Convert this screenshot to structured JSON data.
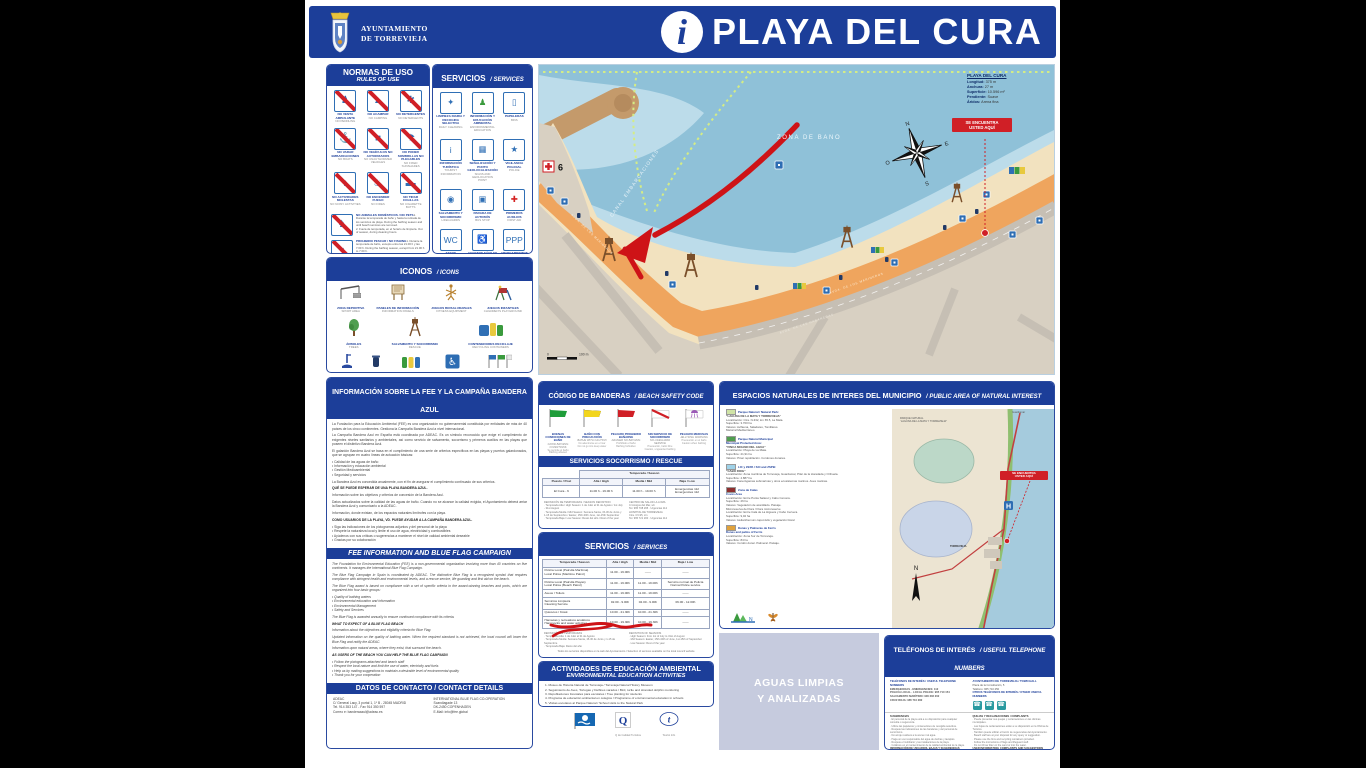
{
  "header": {
    "muni1": "AYUNTAMIENTO",
    "muni2": "DE TORREVIEJA",
    "info_glyph": "i",
    "title": "PLAYA DEL CURA"
  },
  "normas": {
    "title": "NORMAS DE USO",
    "subtitle": "RULES OF USE",
    "items": [
      {
        "glyph": "♟",
        "es": "NO VENTA AMBULANTE",
        "en": "NO PEDDLING"
      },
      {
        "glyph": "▲",
        "es": "NO ACAMPAR",
        "en": "NO CAMPING"
      },
      {
        "glyph": "✱",
        "es": "NO DETERGENTES",
        "en": "NO DETERGENTS"
      },
      {
        "glyph": "⚓",
        "es": "NO VARAR EMBARCACIONES",
        "en": "NO BOATS"
      },
      {
        "glyph": "■",
        "es": "NO VEHÍCULOS NO AUTORIZADOS",
        "en": "NO UNAUTHORIZED VEHICLES"
      },
      {
        "glyph": "☂",
        "es": "NO PONER SOMBRILLAS NO PLEGABLES",
        "en": "NO FIXED SUNSHADES"
      },
      {
        "glyph": "♪",
        "es": "NO ACTIVIDADES MOLESTAS",
        "en": "NO NOISY ACTIVITIES"
      },
      {
        "glyph": "♨",
        "es": "NO ENCENDER FUEGO",
        "en": "NO FIRES"
      },
      {
        "glyph": "▬",
        "es": "NO TIRAR COLILLAS",
        "en": "NO CIGARETTE BUTTS"
      }
    ],
    "extras": [
      {
        "glyph": "♞",
        "title": "NO ANIMALES DOMÉSTICOS / NO PETS",
        "text": "1. Durante la temporada de baño y hasta la retirada de los servicios de playa. During the bathing season and until beach services are removed.\n2. Fuera de temporada, en el horario de limpieza. Out of season, during cleaning hours."
      },
      {
        "glyph": "♆",
        "title": "PROHIBIDO PESCAR / NO FISHING",
        "text": "1. Durante la temporada de baño, excepto entre las 21.00 h y las 7.00 h. During the bathing season, except from 21.00 h to 7.00 h.\n2. Prohibida la pesca submarina en las zonas de baño. Spearfishing is forbidden in bathing areas."
      }
    ]
  },
  "servicios_panel": {
    "title": "SERVICIOS",
    "subtitle": "SERVICES",
    "items": [
      {
        "glyph": "✦",
        "color": "#2f6fb5",
        "es": "LIMPIEZA DIARIA Y RECOGIDA SELECTIVA",
        "en": "DAILY CLEANING"
      },
      {
        "glyph": "♟",
        "color": "#3a9a3d",
        "es": "INFORMACIÓN Y EDUCACIÓN AMBIENTAL",
        "en": "ENVIRONMENTAL EDUCATION"
      },
      {
        "glyph": "▯",
        "color": "#2f6fb5",
        "es": "PAPELERAS",
        "en": "BINS"
      },
      {
        "glyph": "i",
        "color": "#2f6fb5",
        "es": "INFORMACIÓN TURÍSTICA",
        "en": "TOURIST INFORMATION"
      },
      {
        "glyph": "▦",
        "color": "#2f6fb5",
        "es": "SEÑALIZACIÓN Y PUNTO GEOLOCALIZACIÓN",
        "en": "SIGNS AND GEOLOCATION POINT"
      },
      {
        "glyph": "★",
        "color": "#2f6fb5",
        "es": "VIGILANCIA POLICIAL",
        "en": "POLICE"
      },
      {
        "glyph": "◉",
        "color": "#2f6fb5",
        "es": "SALVAMENTO Y SOCORRISMO",
        "en": "LIFEGUARDS"
      },
      {
        "glyph": "▣",
        "color": "#2f6fb5",
        "es": "PARADA DE AUTOBÚS",
        "en": "BUS STOP"
      },
      {
        "glyph": "✚",
        "color": "#d42222",
        "es": "PRIMEROS AUXILIOS",
        "en": "FIRST AID"
      },
      {
        "glyph": "WC",
        "color": "#2f6fb5",
        "es": "ASEOS ADAPTADOS",
        "en": "ADAPTED TOILETS"
      },
      {
        "glyph": "♿",
        "color": "#2f6fb5",
        "es": "ACCESOS FÁCILES Y SEGUROS",
        "en": "EASY AND SAFE ACCESS"
      },
      {
        "glyph": "PPP",
        "color": "#2f6fb5",
        "es": "APARCAMIENTOS RESERVADOS",
        "en": "RESERVED PARKING"
      }
    ]
  },
  "iconos": {
    "title": "ICONOS",
    "subtitle": "ICONS",
    "items": [
      {
        "es": "ZONA DEPORTIVA",
        "en": "SPORT AREA"
      },
      {
        "es": "PANELES DE INFORMACIÓN",
        "en": "INFORMATION PANELS"
      },
      {
        "es": "JUEGOS BIOSALUDABLES",
        "en": "FITNESS EQUIPMENT"
      },
      {
        "es": "JUEGOS INFANTILES",
        "en": "CHILDREN'S PLAYGROUND"
      },
      {
        "es": "ÁRBOLES",
        "en": "TREES"
      },
      {
        "es": "SALVAMENTO Y SOCORRISMO",
        "en": "RESCUE"
      },
      {
        "es": "CONTENEDORES RECICLAJE",
        "en": "RECYCLING CONTAINERS"
      },
      {
        "es": "LAVAPIÉS",
        "en": "FOOT SHOWERS"
      },
      {
        "es": "PAPELERA",
        "en": "BIN"
      },
      {
        "es": "PAPELERAS RECICLAJE",
        "en": "RECYCLING BINS"
      },
      {
        "es": "ASEO ADAPTADO",
        "en": "ADAPTED TOILET"
      },
      {
        "es": "BANDERAS Y CERTIFICACIONES",
        "en": "FLAGS AND CERTIFICATIONS"
      }
    ]
  },
  "fee": {
    "title": "INFORMACIÓN SOBRE LA FEE Y LA CAMPAÑA BANDERA AZUL",
    "es_blocks": [
      {
        "cls": "p",
        "text": "La Fundación para la Educación Ambiental (FEE) es una organización no gubernamental constituida por entidades de más de 40 países de los cinco continentes. Gestiona la Campaña Bandera Azul a nivel internacional."
      },
      {
        "cls": "p",
        "text": "La Campaña Bandera Azul en España está coordinada por ADEAC. Es un símbolo reconocido que exige el cumplimiento de exigentes niveles sanitarios y ambientales, así como servicio de salvamento, socorrismo y primeros auxilios en las playas que poseen el distintivo Bandera Azul."
      },
      {
        "cls": "p",
        "text": "El galardón Bandera Azul se basa en el cumplimiento de una serie de criterios específicos en las playas y puertos galardonados, que se agrupan en cuatro líneas de actuación básicas:"
      },
      {
        "cls": "p",
        "text": "• Calidad de las aguas de baño\n• Información y educación ambiental\n• Gestión Medioambiental\n• Seguridad y servicios"
      },
      {
        "cls": "p",
        "text": "La Bandera Azul es concedida anualmente, con el fin de asegurar el cumplimiento continuado de sus criterios."
      },
      {
        "cls": "h",
        "text": "QUÉ SE PUEDE ESPERAR DE UNA PLAYA BANDERA AZUL."
      },
      {
        "cls": "p",
        "text": "Información sobre los objetivos y criterios de concesión de la Bandera Azul."
      },
      {
        "cls": "p",
        "text": "Datos actualizados sobre la calidad de las aguas de baño. Cuando no se alcance la calidad exigida, el Ayuntamiento deberá arriar la Bandera Azul y comunicarlo a la ADEAC."
      },
      {
        "cls": "p",
        "text": "Información, donde existan, de los espacios naturales limítrofes con la playa."
      },
      {
        "cls": "h",
        "text": "COMO USUARIOS DE LA PLAYA, VD. PUEDE AYUDAR A LA CAMPAÑA BANDERA AZUL."
      },
      {
        "cls": "p",
        "text": "• Siga las indicaciones de los pictogramas adjuntos y del personal de la playa\n• Respete la naturaleza local y limite el uso de agua, electricidad y combustibles\n• Ayúdenos con sus críticas o sugerencias a mantener el nivel de calidad ambiental deseable\n• Gracias por su colaboración"
      }
    ],
    "mid": "FEE INFORMATION AND BLUE FLAG CAMPAIGN",
    "en_blocks": [
      {
        "cls": "p",
        "text": "The Foundation for Environmental Education (FEE) is a non-governmental organization involving more than 40 countries on five continents. It manages the International Blue Flag Campaign."
      },
      {
        "cls": "p",
        "text": "The Blue Flag Campaign in Spain is coordinated by ADEAC. The distinctive Blue Flag is a recognized symbol that requires compliance with stringent health and environmental levels, and a rescue service, life guarding and first aid on the beach."
      },
      {
        "cls": "p",
        "text": "The Blue Flag award is based on compliance with a set of specific criteria in the award-winning beaches and ports, which are organized into four basic groups:"
      },
      {
        "cls": "p",
        "text": "• Quality of bathing waters\n• Environmental education and information\n• Environmental Management\n• Safety and Services"
      },
      {
        "cls": "p",
        "text": "The Blue Flag is awarded annually to ensure continued compliance with its criteria."
      },
      {
        "cls": "h",
        "text": "WHAT TO EXPECT OF A BLUE FLAG BEACH"
      },
      {
        "cls": "p",
        "text": "Information about the objectives and eligibility criteria for Blue Flag."
      },
      {
        "cls": "p",
        "text": "Updated information on the quality of bathing water. When the required standard is not achieved, the local council will lower the Blue Flag and notify the ADEAC."
      },
      {
        "cls": "p",
        "text": "Information upon natural areas, where they exist, that surround the beach."
      },
      {
        "cls": "h",
        "text": "AS USERS OF THE BEACH YOU CAN HELP THE BLUE FLAG CAMPAIGN"
      },
      {
        "cls": "p",
        "text": "• Follow the pictograms attached and beach staff\n• Respect the local nature and limit the use of water, electricity and fuels\n• Help us by making suggestions to maintain a desirable level of environmental quality\n• Thank you for your cooperation"
      }
    ],
    "contact_title": "DATOS DE CONTACTO / CONTACT DETAILS",
    "contact_left": "ADEAC\nC/ General Lacy, 3 portal 1, 1º B - 28045 MADRID\nTel. 914 353 147 - Fax 914 350 597\nCorreo e: banderaazul@adeac.es",
    "contact_right": "INTERNATIONAL BLUE FLAG CO-OPERATION\nScandiagade 13\nDK-2450 COPENHAGEN\nE-Mail: info@fee.global"
  },
  "map": {
    "stats_title": "PLAYA DEL CURA",
    "stats": [
      {
        "k": "Longitud:",
        "v": "375 m"
      },
      {
        "k": "Anchura:",
        "v": "27 m"
      },
      {
        "k": "Superficie:",
        "v": "10.596 m²"
      },
      {
        "k": "Pendiente:",
        "v": "Suave"
      },
      {
        "k": "Áridos:",
        "v": "Arena fina"
      }
    ],
    "zona": "ZONA DE BAÑO",
    "canal": "CANAL EMBARCACIONES",
    "here": "SE ENCUENTRA\nUSTED AQUÍ",
    "street_prom": "AVDA. DE LOS MARINEROS",
    "street_back": "AVDA. DE LAS HABANERAS",
    "first_aid_num": "6",
    "compass": {
      "n": "N",
      "s": "S",
      "e": "E",
      "o": "O"
    },
    "scale_left": "0",
    "scale_right": "100 m"
  },
  "banderas": {
    "title": "CÓDIGO DE BANDERAS",
    "subtitle": "BEACH SAFETY CODE",
    "flags": [
      {
        "es": "BUENAS CONDICIONES DE BAÑO",
        "en": "GOOD BATHING CONDITIONS",
        "note": "Se permite el baño\nBathing allowed"
      },
      {
        "es": "BAÑO CON PRECAUCIÓN",
        "en": "BATHE WITH CAUTION",
        "note": "No adentrarse en el mar\nDo not go into deep water"
      },
      {
        "es": "PELIGRO PROHIBIDO BAÑARSE",
        "en": "DANGER NO BATHING",
        "note": "Prohibido el baño\nBathing forbidden"
      },
      {
        "es": "SIN SERVICIO DE SOCORRISMO",
        "en": "NO LIFEGUARD SERVICE",
        "note": "Precaución, baño libre\nCaution, unguarded bathing"
      },
      {
        "es": "PELIGRO MEDUSAS",
        "en": "JELLYFISH WARNING",
        "note": "Precaución en el baño\nCaution when bathing"
      }
    ]
  },
  "socorrismo": {
    "title": "SERVICIOS SOCORRISMO / RESCUE",
    "season_header": "Temporada / Season",
    "col_post": "Puesto / Post",
    "col_alta": "Alta / High",
    "col_media": "Media / Mid",
    "col_baja": "Baja / Low",
    "row": {
      "post": "El Cura - 6",
      "alta": "11.00 h - 19.00 h",
      "media": "11.00 h - 19.00 h",
      "baja": "Emergencias 112\nEmergencies 112"
    },
    "notes_left": "DEFINICIÓN DE TEMPORADAS / SEASON DEFINITION\n· Temporada Alta / High Season: 1 de Julio al 31 de Agosto / 1st July - 31st August\n· Temporada Media / Mid Season: Semana Santa, 15-30 de Junio y 1-15 de Septiembre / Easter, 15th-30th June, 1st-15th September\n· Temporada Baja / Low Season: Resto del año / Rest of the year",
    "notes_right": "CENTRO DE SALUD LA LOMA\nC/ Amigos del Mar, s/n\nTel. 965 708 295 · Urgencias 112\nHOSPITAL DE TORREVIEJA\nCtra. CV-95, s/n\nTel. 965 721 200 · Urgencias 112"
  },
  "servicios_tabla": {
    "title": "SERVICIOS",
    "subtitle": "SERVICES",
    "cols": [
      "Temporada / Season",
      "Alta / High",
      "Media / Mid",
      "Baja / Low"
    ],
    "rows": [
      {
        "label": "Policía Local (Patrulla Marítima)\nLocal Police (Maritime Patrol)",
        "alta": "11.00 - 19.00h",
        "media": "——",
        "baja": "——"
      },
      {
        "label": "Policía Local (Patrulla Playas)\nLocal Police (Beach Patrol)",
        "alta": "11.00 - 19.00h",
        "media": "11.00 - 19.00h",
        "baja": "Servicio normal de Policía\nNormal Police service"
      },
      {
        "label": "Aseos / Toilets",
        "alta": "11.00 - 19.00h",
        "media": "11.00 - 19.00h",
        "baja": "——"
      },
      {
        "label": "Servicios Limpieza\nCleaning Service",
        "alta": "02.00 - 9.00h",
        "media": "02.00 - 9.00h",
        "baja": "06.00 - 12.00h"
      },
      {
        "label": "Quioscos / Kiosk",
        "alta": "10.00 - 21.30h",
        "media": "10.00 - 21.30h",
        "baja": "——"
      },
      {
        "label": "Hamacas y recreativos acuáticos\nHammocks and water activities",
        "alta": "10.00 - 19.30h",
        "media": "10.00 - 19.30h",
        "baja": "——"
      }
    ],
    "notes_left": "DEFINICIÓN DE TEMPORADAS\n· Temporada Alta: 1 de Julio al 31 de Agosto\n· Temporada Media: Semana Santa, 15-30 de Junio y 1-15 de Septiembre\n· Temporada Baja: Resto del año",
    "notes_right": "DEFINITION OF SEASONS\n· High Season: from 1st of July to 31st of August\n· Mid Season: Easter, 15th-30th of June, 1st-15th of September\n· Low Season: Rest of the year",
    "footnote": "Todos los servicios disponibles en la web del Ayuntamiento / Selection of services available on the local council website"
  },
  "actividades": {
    "title": "ACTIVIDADES DE EDUCACIÓN AMBIENTAL",
    "subtitle": "ENVIRONMENTAL EDUCATION ACTIVITIES",
    "items": "1. Museo de Historia Natural de Torrevieja / Torrevieja Natural History Museum\n2. Seguimiento de Aves, Tortugas y Delfines varados / Bird, turtle and stranded dolphin monitoring\n3. Repoblaciones forestales para escolares / Tree planting for students\n4. Programa de educación ambiental en colegios / Programme of environmental education in schools\n5. Visitas escolares al Parque Natural / School visits to the Natural Park",
    "logo_q_caption": "Q de Calidad Turística",
    "logo_t_caption": "Tourist Info"
  },
  "espacios": {
    "title": "ESPACIOS NATURALES DE INTERES DEL MUNICIPIO",
    "subtitle": "PUBLIC AREA OF NATURAL INTEREST",
    "items": [
      {
        "swatch": "#cfe3a6",
        "head": "Parque Natural / Natural Park:",
        "name": "“LAGUNA DE LA MATA Y TORREVIEJA”",
        "body": "Localización: Ctra. N-332, km 65.5, La Mata.\nSuperficie: 3.700 ha\nValores: Avifauna, Saladares, Tomillares.\nMatorral Mediterráneo"
      },
      {
        "swatch": "#4f9e4f",
        "head": "Parque Natural Municipal\nMunicipal Protected Area:",
        "name": "“FINCA MOLINO DEL AGUA”",
        "body": "Localización: Playa de La Mata.\nSuperficie: 21,91 ha\nValores: Pinar repoblación. Cordones dunares."
      },
      {
        "swatch": "#9fd2e8",
        "head": "LIC y ZEPA / SCI and ZSPB:",
        "name": "“CABO ROIG”",
        "body": "Localización: Zona marítima de Torrevieja, Guardamar, Pilar de la Horadada y Orihuela.\nSuperficie: 4.887 ha\nValores: Fanerógamas submarinas y otros ecosistemas marinos. Aves marinas."
      },
      {
        "swatch": "#8e2f2f",
        "head": "Zona de Calas\nCoves Area",
        "name": "",
        "body": "Localización: Entre Punta Salaret y Cabo Cervera.\nSuperficie: 26 ha\nValores: Vegetación de acantilado. Paisaje.\nMicroreserva de Flora / Flora microreserve\nLocalización: Entre Cala de La Higuera y Cabo Cervera.\nSuperficie: 9,02 ha\nValores: Helianthemum caput-felis y vegetación litoral"
      },
      {
        "swatch": "#e0a23c",
        "head": "Dunas y Palmeras de Ferris\nDunes and palms of Ferris",
        "name": "",
        "body": "Localización: Zona Sur de Torrevieja.\nSuperficie: 84 ha\nValores: Cordón dunar. Palmeral. Paisaje."
      }
    ],
    "map_labels": {
      "park": "PARQUE NATURAL\n“LAGUNA DE LA MATA Y TORREVIEJA”",
      "city": "TORREVIEJA",
      "here": "SE ENCUENTRA\nUSTED AQUÍ",
      "top": "Guardamar",
      "bottom": "Cartagena",
      "h": "H",
      "n": "N"
    }
  },
  "aguas": {
    "line1": "AGUAS LIMPIAS",
    "line2": "Y ANALIZADAS"
  },
  "telefonos": {
    "title": "TELÉFONOS DE INTERÉS",
    "subtitle": "USEFUL TELEPHONE NUMBERS",
    "left_head": "TELÉFONOS DE INTERÉS / USEFUL TELEPHONE NUMBERS",
    "left_lines": "EMERGENCIAS · EMERGENCIES: 112\nPOLICÍA LOCAL · LOCAL POLICE: 965 710 154\nSALVAMENTO MARÍTIMO: 900 202 202\nCRUZ ROJA: 965 710 282",
    "right_head": "AYUNTAMIENTO DE TORREVIEJA / TOWN HALL",
    "right_lines": "Plaza de la Constitución, 5\nTeléfono: 965 710 250",
    "others_head": "OTROS TELÉFONOS DE INTERÉS / OTHER USEFUL NUMBERS",
    "sug_head": "SUGERENCIAS",
    "sug_text": "· El personal de la playa está a su disposición para cualquier consulta o sugerencia.\n· Utilice las papeleras y contenedores de recogida selectiva.\n· Respete las indicaciones de las banderas y del personal de socorrismo.\n· No arroje residuos a la arena ni al agua.\n· Haga un uso responsable del agua de duchas y lavapiés.\n· Respete el mobiliario y las instalaciones de la playa.\n· Colabore en el mantenimiento de la calidad ambiental de la playa.",
    "quejas_head": "QUEJAS Y RECLAMACIONES / COMPLAINTS",
    "quejas_text": "· Puede presentar sus quejas y reclamaciones en las oficinas municipales.\n· Las hojas de reclamaciones están a su disposición en la Oficina de Turismo.\n· También puede utilizar el buzón de sugerencias del Ayuntamiento.\n· Beach staff are at your disposal for any query or suggestion.\n· Please use the bins and recycling containers provided.\n· Follow the instructions of flags and lifeguard staff.\n· Do not throw litter on the sand or into the water.",
    "info_head": "INFORMACIÓN DE USUARIOS, BAJAS Y SUGERENCIAS",
    "info_text": "· Oficina Municipal de Turismo: Paseo Vista Alegre, s/n\n· Concejalía de Playas: Plaza de la Constitución, 5\n· www.torrevieja.es",
    "user_head": "USER INFORMATION, COMPLAINTS AND SUGGESTIONS",
    "user_text": "· Municipal Tourist Office: Paseo Vista Alegre, s/n\n· Beaches Department: Plaza de la Constitución, 5\n· www.torrevieja.es"
  }
}
